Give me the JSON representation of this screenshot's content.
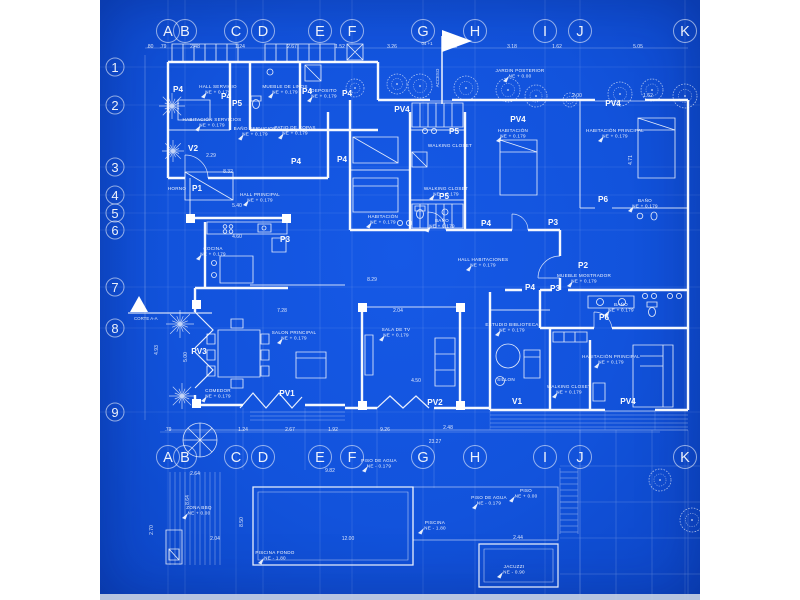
{
  "sheet": {
    "paper_color": "#1253dc",
    "ink_color": "#ffffff",
    "margin_color": "#ffffff",
    "edge_strip_color": "#c9d3e4"
  },
  "grid": {
    "columns": [
      {
        "label": "A",
        "x": 68
      },
      {
        "label": "B",
        "x": 85
      },
      {
        "label": "C",
        "x": 136
      },
      {
        "label": "D",
        "x": 163
      },
      {
        "label": "E",
        "x": 220
      },
      {
        "label": "F",
        "x": 252
      },
      {
        "label": "G",
        "x": 323
      },
      {
        "label": "H",
        "x": 375
      },
      {
        "label": "I",
        "x": 445
      },
      {
        "label": "J",
        "x": 480
      },
      {
        "label": "K",
        "x": 585
      }
    ],
    "rows": [
      {
        "label": "1",
        "y": 67
      },
      {
        "label": "2",
        "y": 105
      },
      {
        "label": "3",
        "y": 167
      },
      {
        "label": "4",
        "y": 195
      },
      {
        "label": "5",
        "y": 213
      },
      {
        "label": "6",
        "y": 230
      },
      {
        "label": "7",
        "y": 287
      },
      {
        "label": "8",
        "y": 328
      },
      {
        "label": "9",
        "y": 412
      }
    ],
    "top_row_y": 31,
    "bottom_row_y": 457,
    "row_col_x": 15
  },
  "rooms": [
    {
      "n": "HALL SERVICIO",
      "e": "NE + 0.179",
      "x": 118,
      "y": 88
    },
    {
      "n": "MUEBLE DE LINOS",
      "e": "NE + 0.179",
      "x": 185,
      "y": 88
    },
    {
      "n": "DEPOSITO",
      "e": "NE + 0.179",
      "x": 224,
      "y": 92
    },
    {
      "n": "HABITACIÓN SERVICIOS",
      "e": "NE + 0.179",
      "x": 112,
      "y": 121
    },
    {
      "n": "BAÑO SERVICIOS",
      "e": "NE + 0.179",
      "x": 155,
      "y": 130
    },
    {
      "n": "PATIO DE ROPAS",
      "e": "NE + 0.179",
      "x": 195,
      "y": 129
    },
    {
      "n": "HORNO",
      "x": 77,
      "y": 190
    },
    {
      "n": "HALL PRINCIPAL",
      "e": "NE + 0.179",
      "x": 160,
      "y": 196
    },
    {
      "n": "COCINA",
      "e": "NE + 0.179",
      "x": 113,
      "y": 250
    },
    {
      "n": "COMEDOR",
      "e": "NE + 0.179",
      "x": 118,
      "y": 392
    },
    {
      "n": "SALON PRINCIPAL",
      "e": "NE + 0.179",
      "x": 194,
      "y": 334
    },
    {
      "n": "SALA DE TV",
      "e": "NE + 0.179",
      "x": 296,
      "y": 331
    },
    {
      "n": "HALL HABITACIONES",
      "e": "NE + 0.179",
      "x": 383,
      "y": 261
    },
    {
      "n": "ESTUDIO BIBLIOTECA",
      "e": "NE + 0.179",
      "x": 412,
      "y": 326
    },
    {
      "n": "HABITACIÓN",
      "e": "NE + 0.179",
      "x": 283,
      "y": 218
    },
    {
      "n": "HABITACIÓN",
      "e": "NE + 0.179",
      "x": 413,
      "y": 132
    },
    {
      "n": "WALKING CLOSET",
      "x": 350,
      "y": 147
    },
    {
      "n": "WALKING CLOSET",
      "e": "NE + 0.179",
      "x": 346,
      "y": 190
    },
    {
      "n": "BAÑO",
      "e": "NE + 0.179",
      "x": 342,
      "y": 222
    },
    {
      "n": "HABITACIÓN PRINCIPAL",
      "e": "NE + 0.179",
      "x": 515,
      "y": 132
    },
    {
      "n": "BAÑO",
      "e": "NE + 0.179",
      "x": 545,
      "y": 202
    },
    {
      "n": "MUEBLE MOSTRADOR",
      "e": "NE + 0.179",
      "x": 484,
      "y": 277
    },
    {
      "n": "BAÑO",
      "e": "NE + 0.179",
      "x": 521,
      "y": 306
    },
    {
      "n": "HABITACIÓN PRINCIPAL",
      "e": "NE + 0.179",
      "x": 511,
      "y": 358
    },
    {
      "n": "WALKING CLOSET",
      "e": "NE + 0.179",
      "x": 469,
      "y": 388
    },
    {
      "n": "SILLON",
      "x": 406,
      "y": 381
    },
    {
      "n": "JARDIN POSTERIOR",
      "e": "NE + 0.00",
      "x": 420,
      "y": 72
    },
    {
      "n": "ZONA BBQ",
      "e": "NE + 0.00",
      "x": 99,
      "y": 509
    },
    {
      "n": "PISCINA FONDO",
      "e": "NE - 1.80",
      "x": 175,
      "y": 554
    },
    {
      "n": "PISCINA",
      "e": "NE - 1.80",
      "x": 335,
      "y": 524
    },
    {
      "n": "PISO DE AGUA",
      "e": "NE - 0.179",
      "x": 389,
      "y": 499
    },
    {
      "n": "PISO",
      "e": "NE + 0.00",
      "x": 426,
      "y": 492
    },
    {
      "n": "JACUZZI",
      "e": "NE - 0.90",
      "x": 414,
      "y": 568
    },
    {
      "n": "PISO DE AGUA",
      "e": "NE - 0.179",
      "x": 279,
      "y": 462
    }
  ],
  "doors": [
    {
      "t": "P1",
      "x": 97,
      "y": 191
    },
    {
      "t": "P2",
      "x": 483,
      "y": 268
    },
    {
      "t": "P3",
      "x": 185,
      "y": 242
    },
    {
      "t": "P3",
      "x": 453,
      "y": 225
    },
    {
      "t": "P3",
      "x": 455,
      "y": 291
    },
    {
      "t": "P4",
      "x": 78,
      "y": 92
    },
    {
      "t": "P4",
      "x": 126,
      "y": 99
    },
    {
      "t": "P4",
      "x": 207,
      "y": 94
    },
    {
      "t": "P4",
      "x": 247,
      "y": 96
    },
    {
      "t": "P4",
      "x": 196,
      "y": 164
    },
    {
      "t": "P4",
      "x": 242,
      "y": 162
    },
    {
      "t": "P4",
      "x": 386,
      "y": 226
    },
    {
      "t": "P4",
      "x": 430,
      "y": 290
    },
    {
      "t": "P5",
      "x": 137,
      "y": 106
    },
    {
      "t": "P5",
      "x": 354,
      "y": 134
    },
    {
      "t": "P5",
      "x": 344,
      "y": 199
    },
    {
      "t": "P6",
      "x": 503,
      "y": 202
    },
    {
      "t": "P6",
      "x": 504,
      "y": 320
    },
    {
      "t": "PV1",
      "x": 187,
      "y": 396
    },
    {
      "t": "PV2",
      "x": 335,
      "y": 405
    },
    {
      "t": "PV3",
      "x": 99,
      "y": 354
    },
    {
      "t": "PV4",
      "x": 302,
      "y": 112
    },
    {
      "t": "PV4",
      "x": 418,
      "y": 122
    },
    {
      "t": "PV4",
      "x": 513,
      "y": 106
    },
    {
      "t": "PV4",
      "x": 528,
      "y": 404
    },
    {
      "t": "V1",
      "x": 417,
      "y": 404
    },
    {
      "t": "V2",
      "x": 93,
      "y": 151
    }
  ],
  "dims": [
    {
      "t": ".80",
      "x": 50,
      "y": 48
    },
    {
      "t": ".79",
      "x": 63,
      "y": 48
    },
    {
      "t": "2.48",
      "x": 95,
      "y": 48
    },
    {
      "t": "1.24",
      "x": 140,
      "y": 48
    },
    {
      "t": "2.67",
      "x": 192,
      "y": 48
    },
    {
      "t": "1.52",
      "x": 240,
      "y": 48
    },
    {
      "t": "3.26",
      "x": 292,
      "y": 48
    },
    {
      "t": "2.48",
      "x": 352,
      "y": 48
    },
    {
      "t": "3.18",
      "x": 412,
      "y": 48
    },
    {
      "t": "1.62",
      "x": 457,
      "y": 48
    },
    {
      "t": "5.05",
      "x": 538,
      "y": 48
    },
    {
      "t": ".79",
      "x": 68,
      "y": 431
    },
    {
      "t": "1.24",
      "x": 143,
      "y": 431
    },
    {
      "t": "2.67",
      "x": 190,
      "y": 431
    },
    {
      "t": "1.92",
      "x": 233,
      "y": 431
    },
    {
      "t": "9.26",
      "x": 285,
      "y": 431
    },
    {
      "t": "2.48",
      "x": 348,
      "y": 429
    },
    {
      "t": "23.27",
      "x": 335,
      "y": 443
    },
    {
      "t": "8.32",
      "x": 128,
      "y": 173
    },
    {
      "t": "2.29",
      "x": 111,
      "y": 157
    },
    {
      "t": "5.40",
      "x": 137,
      "y": 207
    },
    {
      "t": "4.60",
      "x": 137,
      "y": 238
    },
    {
      "t": "8.29",
      "x": 272,
      "y": 281
    },
    {
      "t": "2.04",
      "x": 298,
      "y": 312
    },
    {
      "t": "4.50",
      "x": 316,
      "y": 382
    },
    {
      "t": "7.28",
      "x": 182,
      "y": 312
    },
    {
      "t": "2.00",
      "x": 477,
      "y": 97
    },
    {
      "t": "1.62",
      "x": 548,
      "y": 97
    },
    {
      "t": "2.64",
      "x": 95,
      "y": 475
    },
    {
      "t": "9.82",
      "x": 230,
      "y": 472
    },
    {
      "t": "12.00",
      "x": 248,
      "y": 540
    },
    {
      "t": "2.04",
      "x": 115,
      "y": 540
    },
    {
      "t": "2.44",
      "x": 418,
      "y": 539
    },
    {
      "t": "8.64",
      "x": 89,
      "y": 500,
      "r": 1
    },
    {
      "t": "2.70",
      "x": 53,
      "y": 530,
      "r": 1
    },
    {
      "t": "8.50",
      "x": 143,
      "y": 522,
      "r": 1
    },
    {
      "t": "5.00",
      "x": 87,
      "y": 357,
      "r": 1
    },
    {
      "t": "4.93",
      "x": 58,
      "y": 350,
      "r": 1
    },
    {
      "t": "4.71",
      "x": 532,
      "y": 160,
      "r": 1
    }
  ],
  "texts": {
    "section_cut": "CORTE A-A",
    "flag_note": "ACCESO",
    "flag_side_note": "04 +1"
  },
  "landscape": {
    "trees": [
      {
        "x": 255,
        "y": 88,
        "r": 9
      },
      {
        "x": 297,
        "y": 84,
        "r": 10
      },
      {
        "x": 320,
        "y": 86,
        "r": 12
      },
      {
        "x": 366,
        "y": 88,
        "r": 12
      },
      {
        "x": 408,
        "y": 90,
        "r": 12
      },
      {
        "x": 436,
        "y": 96,
        "r": 11
      },
      {
        "x": 470,
        "y": 100,
        "r": 7
      },
      {
        "x": 520,
        "y": 94,
        "r": 12
      },
      {
        "x": 552,
        "y": 90,
        "r": 11
      },
      {
        "x": 585,
        "y": 96,
        "r": 12
      },
      {
        "x": 560,
        "y": 480,
        "r": 11
      },
      {
        "x": 592,
        "y": 520,
        "r": 12
      }
    ],
    "palms": [
      {
        "x": 72,
        "y": 106,
        "r": 13
      },
      {
        "x": 73,
        "y": 151,
        "r": 11
      },
      {
        "x": 80,
        "y": 324,
        "r": 14
      },
      {
        "x": 82,
        "y": 396,
        "r": 13
      }
    ]
  }
}
